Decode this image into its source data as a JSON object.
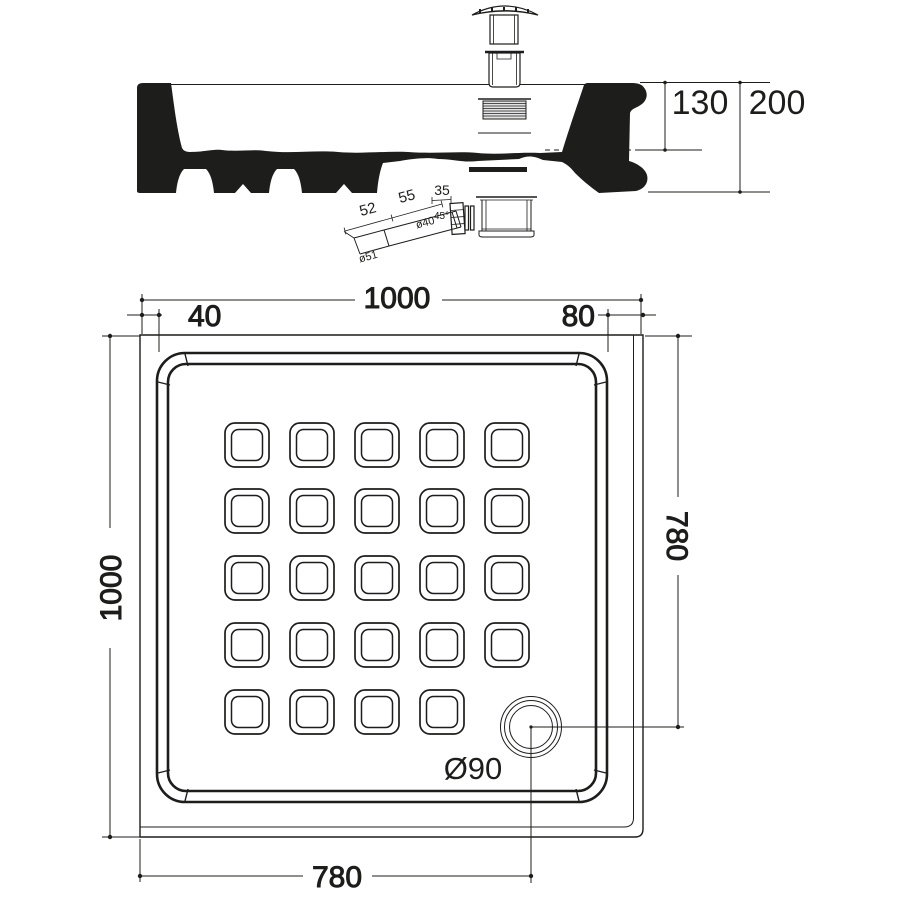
{
  "meta": {
    "background": "#ffffff",
    "line_color": "#1d1d1b",
    "drawing_type": "shower tray technical drawing"
  },
  "section": {
    "height_rim_to_waste": "130",
    "height_total": "200"
  },
  "waste_detail": {
    "connector_width": "35",
    "pipe_segment_upper": "55",
    "pipe_segment_lower": "52",
    "pipe_diameter": "ø40",
    "bend_angle": "45°",
    "outlet_diameter": "ø51"
  },
  "plan": {
    "overall_width": "1000",
    "overall_depth": "1000",
    "rim_left": "40",
    "rim_right": "80",
    "drain_offset_from_top": "780",
    "drain_offset_from_left": "780",
    "drain_diameter": "Ø90"
  }
}
